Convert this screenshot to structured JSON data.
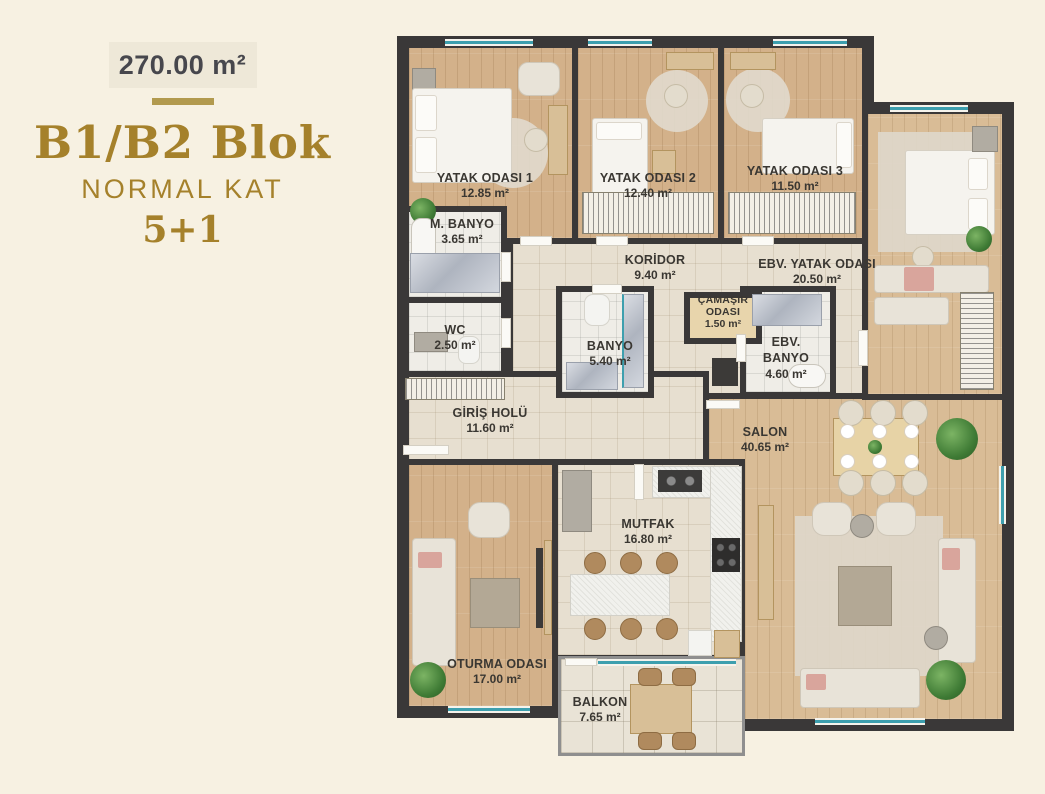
{
  "poster": {
    "total_area": "270.00 m²",
    "title": "B1/B2 Blok",
    "subtitle": "NORMAL KAT",
    "unit_type": "5+1"
  },
  "colors": {
    "background": "#f7f1e2",
    "gold_accent": "#a5812b",
    "divider_gold": "#b29a4e",
    "wall": "#3a3838",
    "wood_floor": "#d3b18a",
    "tile_floor": "#e7dfd0",
    "window_teal": "#3d9fae"
  },
  "rooms": [
    {
      "name": "YATAK ODASI 1",
      "area": "12.85 m²"
    },
    {
      "name": "YATAK ODASI 2",
      "area": "12.40 m²"
    },
    {
      "name": "YATAK ODASI 3",
      "area": "11.50 m²"
    },
    {
      "name": "EBV. YATAK ODASI",
      "area": "20.50 m²"
    },
    {
      "name": "M. BANYO",
      "area": "3.65 m²"
    },
    {
      "name": "KORİDOR",
      "area": "9.40 m²"
    },
    {
      "name": "ÇAMAŞIR ODASI",
      "area": "1.50 m²"
    },
    {
      "name": "WC",
      "area": "2.50 m²"
    },
    {
      "name": "BANYO",
      "area": "5.40 m²"
    },
    {
      "name": "EBV. BANYO",
      "area": "4.60 m²"
    },
    {
      "name": "GİRİŞ HOLÜ",
      "area": "11.60 m²"
    },
    {
      "name": "SALON",
      "area": "40.65 m²"
    },
    {
      "name": "MUTFAK",
      "area": "16.80 m²"
    },
    {
      "name": "OTURMA ODASI",
      "area": "17.00 m²"
    },
    {
      "name": "BALKON",
      "area": "7.65 m²"
    }
  ]
}
